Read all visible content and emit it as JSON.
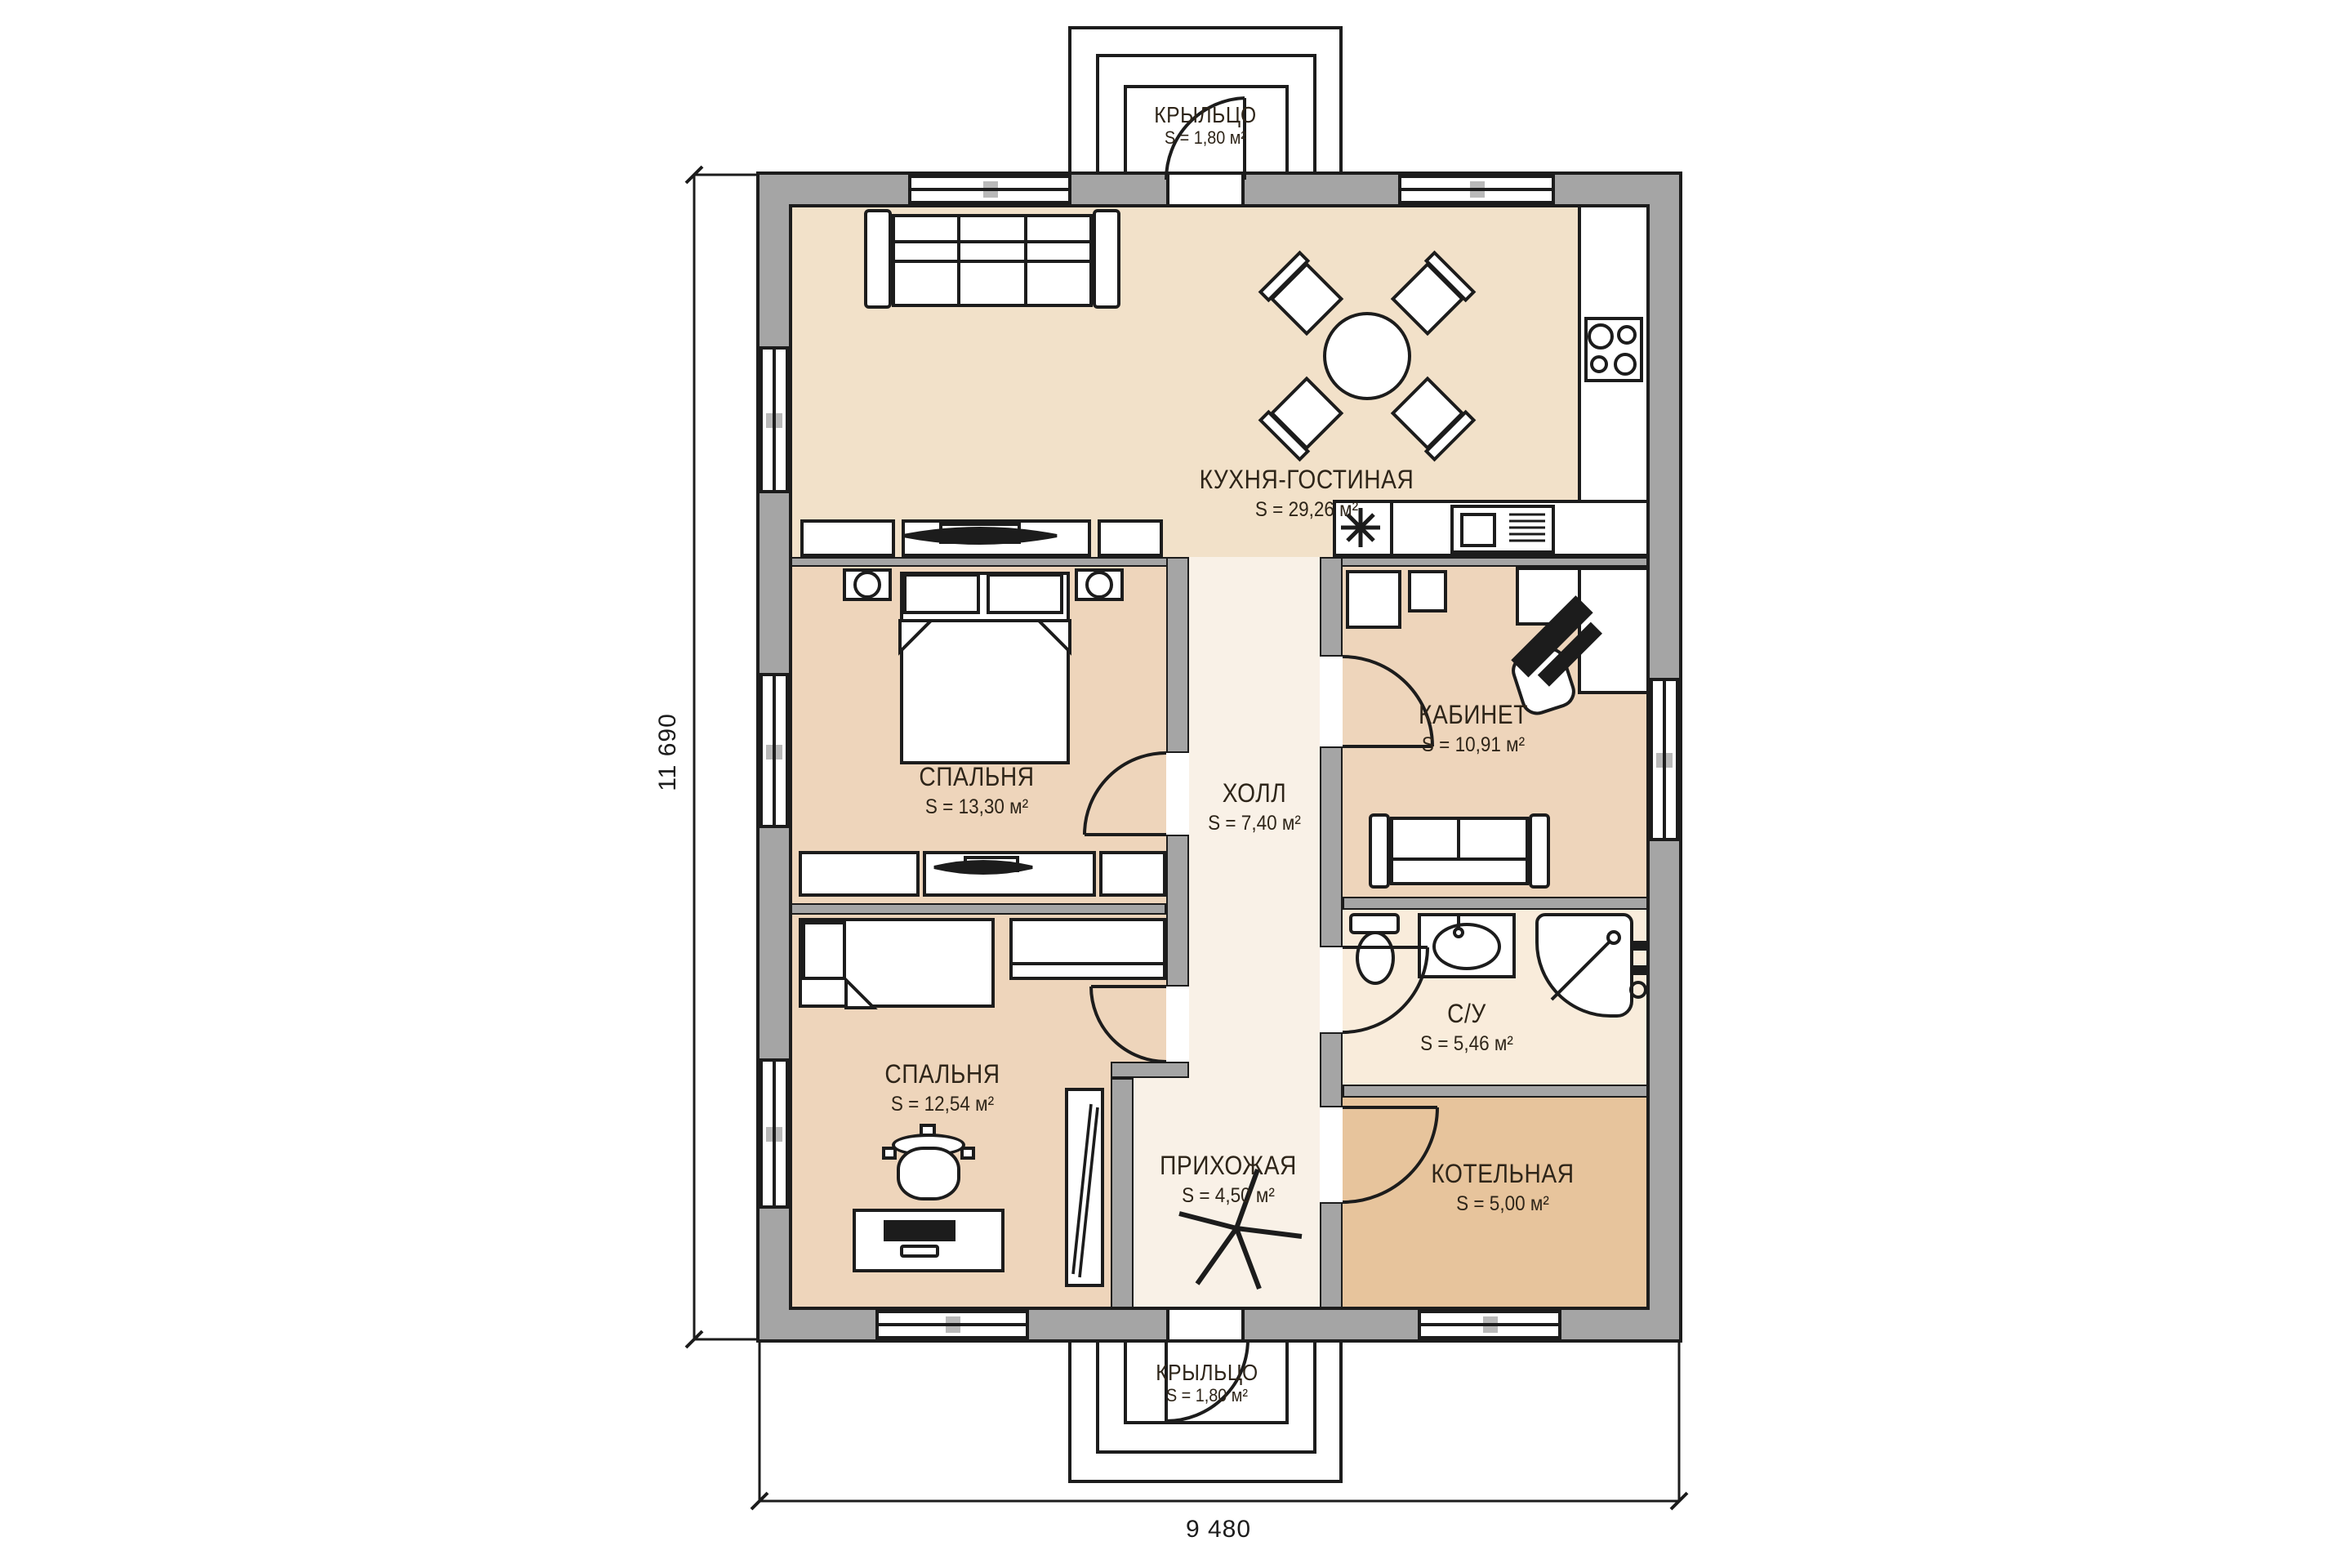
{
  "rooms": {
    "kitchen": {
      "name": "КУХНЯ-ГОСТИНАЯ",
      "area": "S = 29,26 м²"
    },
    "bedroom1": {
      "name": "СПАЛЬНЯ",
      "area": "S = 13,30 м²"
    },
    "office": {
      "name": "КАБИНЕТ",
      "area": "S = 10,91 м²"
    },
    "hall": {
      "name": "ХОЛЛ",
      "area": "S = 7,40 м²"
    },
    "bathroom": {
      "name": "С/У",
      "area": "S = 5,46 м²"
    },
    "bedroom2": {
      "name": "СПАЛЬНЯ",
      "area": "S = 12,54 м²"
    },
    "entry": {
      "name": "ПРИХОЖАЯ",
      "area": "S = 4,50 м²"
    },
    "boiler": {
      "name": "КОТЕЛЬНАЯ",
      "area": "S = 5,00 м²"
    },
    "porch_top": {
      "name": "КРЫЛЬЦО",
      "area": "S = 1,80 м²"
    },
    "porch_bottom": {
      "name": "КРЫЛЬЦО",
      "area": "S = 1,80 м²"
    }
  },
  "dimensions": {
    "height": "11 690",
    "width": "9 480"
  },
  "colors": {
    "kitchen_fill": "#f2e1c9",
    "bedroom_fill": "#eed5bb",
    "hall_fill": "#f9f1e7",
    "bathroom_fill": "#f9ecdb",
    "boiler_fill": "#e7c49c",
    "wall_gray": "#a5a5a5",
    "line": "#1c1c1c",
    "text": "#2e2519"
  }
}
